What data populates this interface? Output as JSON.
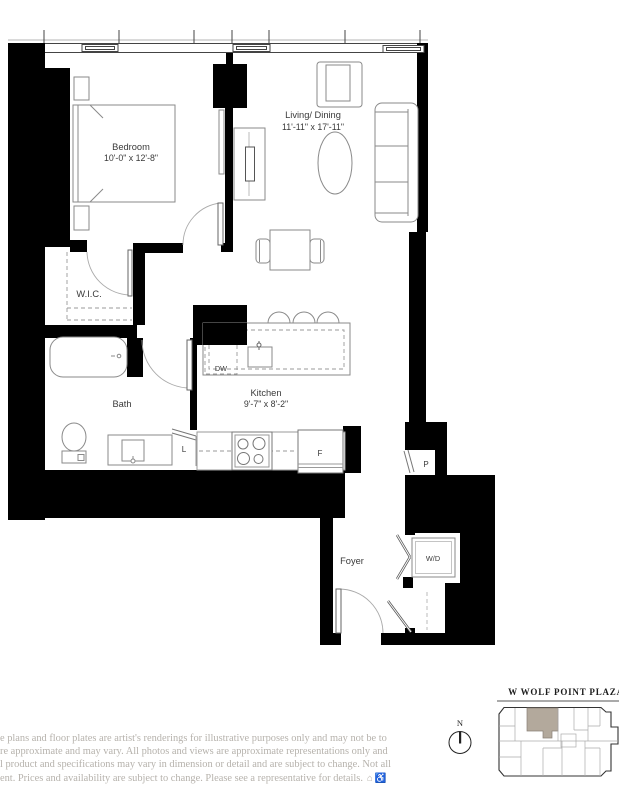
{
  "plan": {
    "rooms": {
      "bedroom": {
        "name": "Bedroom",
        "dims": "10'-0\" x 12'-8\""
      },
      "living_dining": {
        "name": "Living/ Dining",
        "dims": "11'-11\" x 17'-11\""
      },
      "wic": {
        "name": "W.I.C."
      },
      "bath": {
        "name": "Bath"
      },
      "kitchen": {
        "name": "Kitchen",
        "dims": "9'-7\" x 8'-2\""
      },
      "foyer": {
        "name": "Foyer"
      }
    },
    "fixtures": {
      "dishwasher": "DW",
      "linen": "L",
      "fridge": "F",
      "pantry": "P",
      "washer_dryer": "W/D"
    }
  },
  "keyplan": {
    "street_label": "W WOLF POINT PLAZA",
    "compass": "N",
    "highlight_color": "#b3a99c"
  },
  "disclaimer": {
    "line1": "e plans and floor plates are artist's renderings for illustrative purposes only and may not be to",
    "line2": "re approximate and may vary. All photos and views are approximate representations only and",
    "line3": "l product and specifications may vary in dimension or detail and are subject to change. Not all",
    "line4": "ent. Prices and availability are subject to change. Please see a representative for details.",
    "icons": {
      "equal_housing": "⌂",
      "accessibility": "♿"
    }
  }
}
